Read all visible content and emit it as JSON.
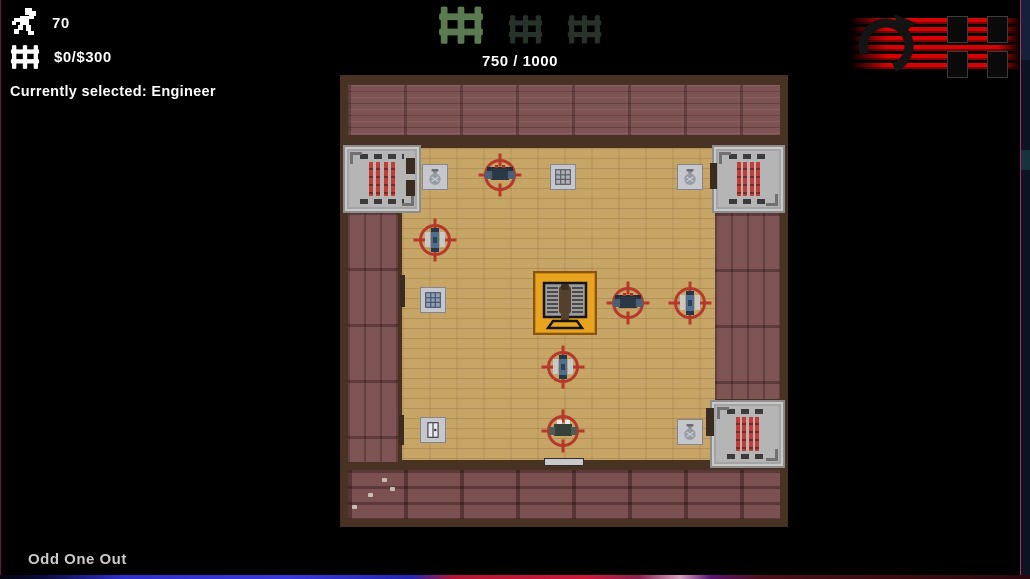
{
  "theme": {
    "accent_orange": "#e9a41f",
    "reticle_red": "#b5392a",
    "wall_brown": "#483223",
    "floor_tan": "#c7a567",
    "floor_maroon": "#7e5354",
    "machine_red": "#c43c34",
    "logo_red": "#d40202",
    "wave_lit": "#5c7a52",
    "wave_dim": "#28322a",
    "hud_text": "#ffffff",
    "footer_text": "#cbcbcb"
  },
  "hud": {
    "population": {
      "icon": "runner-icon",
      "value": "70"
    },
    "money": {
      "icon": "cash-icon",
      "value": "$0/$300"
    },
    "selected_label": "Currently selected: Engineer",
    "wave": {
      "counter": "750 / 1000",
      "icons": [
        {
          "state": "lit",
          "size": 46
        },
        {
          "state": "dim",
          "size": 35
        },
        {
          "state": "dim",
          "size": 35
        }
      ]
    }
  },
  "logo": {
    "label": "CH"
  },
  "footer": {
    "game_title": "Odd One Out"
  },
  "map": {
    "machines": [
      {
        "x": 3,
        "y": 70,
        "w": 78,
        "h": 68
      },
      {
        "x": 372,
        "y": 70,
        "w": 73,
        "h": 68
      },
      {
        "x": 370,
        "y": 325,
        "w": 75,
        "h": 68
      }
    ],
    "floor_tiles": [
      {
        "cx": 95,
        "cy": 102,
        "icon": "money-bag"
      },
      {
        "cx": 223,
        "cy": 102,
        "icon": "vent"
      },
      {
        "cx": 350,
        "cy": 102,
        "icon": "money-bag"
      },
      {
        "cx": 93,
        "cy": 225,
        "icon": "panel"
      },
      {
        "cx": 93,
        "cy": 355,
        "icon": "door"
      },
      {
        "cx": 350,
        "cy": 357,
        "icon": "money-bag"
      }
    ],
    "units": [
      {
        "cx": 160,
        "cy": 100,
        "variant": "front"
      },
      {
        "cx": 95,
        "cy": 165,
        "variant": "side"
      },
      {
        "cx": 288,
        "cy": 228,
        "variant": "front"
      },
      {
        "cx": 350,
        "cy": 228,
        "variant": "side"
      },
      {
        "cx": 223,
        "cy": 292,
        "variant": "side"
      },
      {
        "cx": 223,
        "cy": 356,
        "variant": "front-up"
      }
    ],
    "selected": {
      "x": 193,
      "y": 196,
      "size": 64,
      "label": "engineer"
    },
    "doors": [
      {
        "x": 66,
        "y": 83,
        "w": 9,
        "h": 16,
        "shade": "dark"
      },
      {
        "x": 66,
        "y": 105,
        "w": 9,
        "h": 16,
        "shade": "dark"
      },
      {
        "x": 60,
        "y": 200,
        "w": 5,
        "h": 32,
        "shade": "dark"
      },
      {
        "x": 59,
        "y": 340,
        "w": 5,
        "h": 30,
        "shade": "dark"
      },
      {
        "x": 204,
        "y": 383,
        "w": 40,
        "h": 8,
        "shade": "light"
      },
      {
        "x": 366,
        "y": 333,
        "w": 8,
        "h": 28,
        "shade": "dark"
      },
      {
        "x": 370,
        "y": 88,
        "w": 7,
        "h": 26,
        "shade": "dark"
      }
    ],
    "footprints": [
      {
        "x": 42,
        "y": 403
      },
      {
        "x": 28,
        "y": 418
      },
      {
        "x": 12,
        "y": 430
      },
      {
        "x": 50,
        "y": 412
      }
    ]
  }
}
